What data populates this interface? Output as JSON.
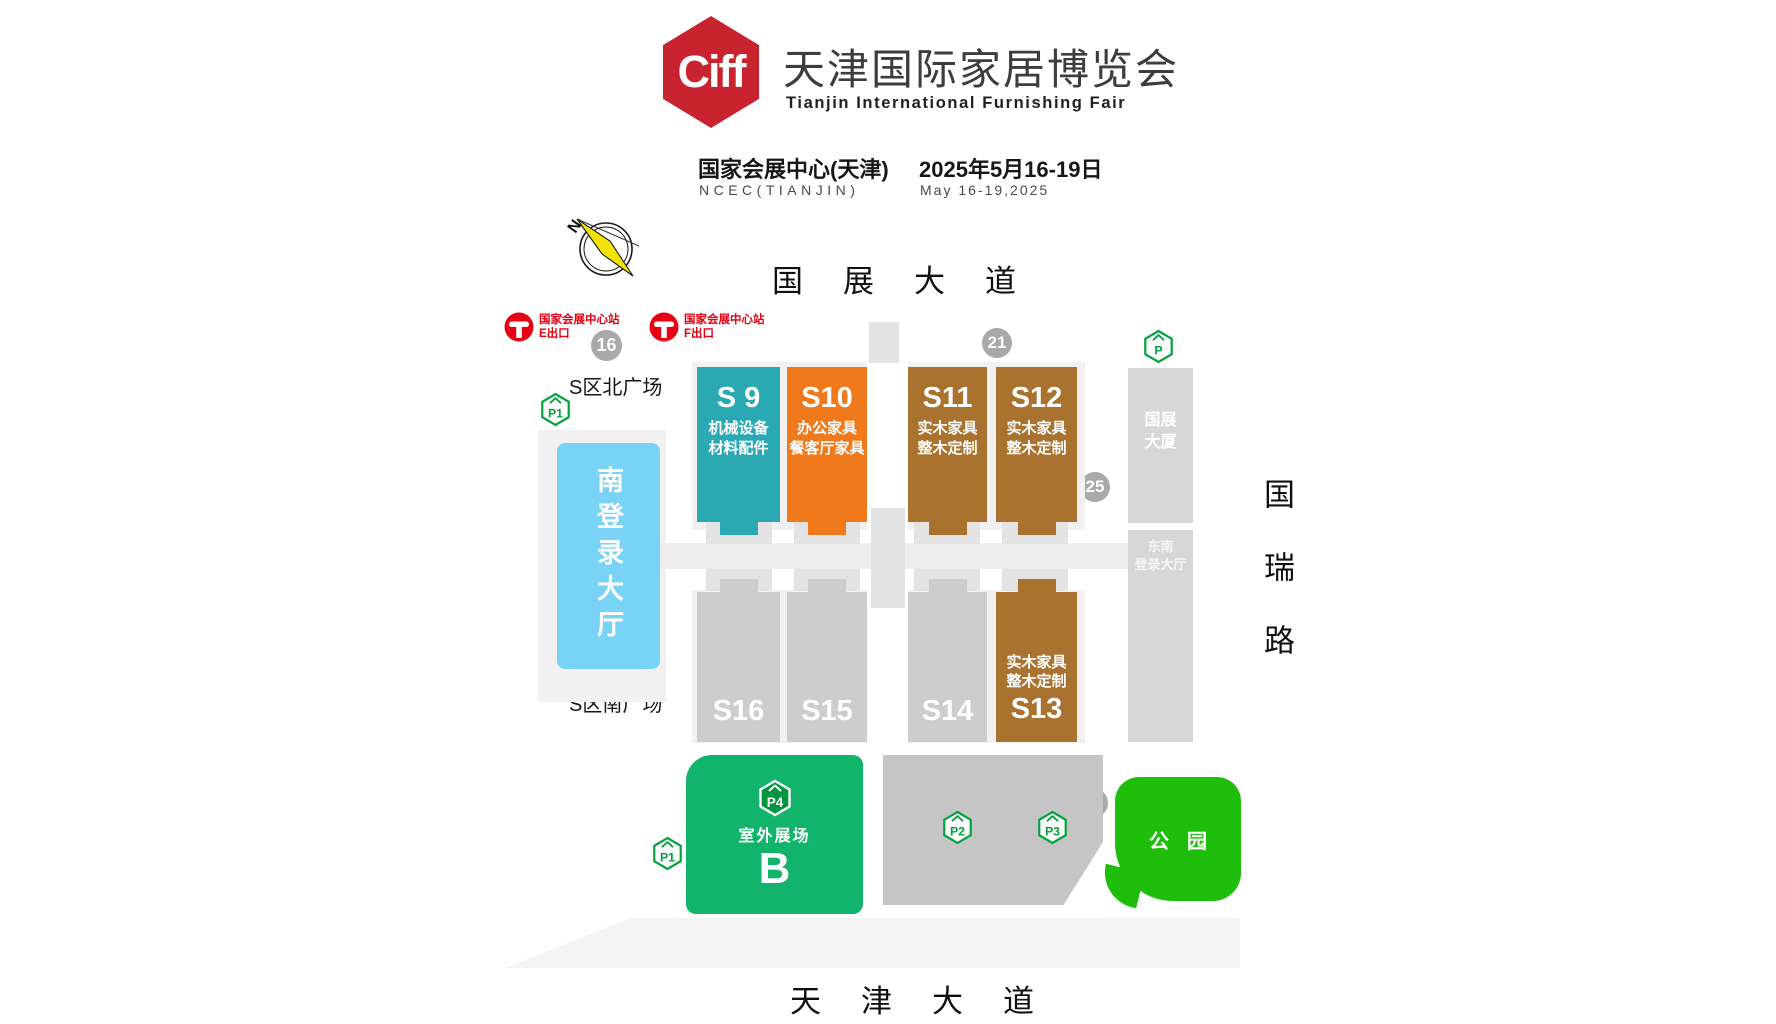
{
  "header": {
    "logo_text": "Ciff",
    "title_cn": "天津国际家居博览会",
    "title_en": "Tianjin International Furnishing Fair",
    "venue_cn": "国家会展中心(天津)",
    "venue_en": "NCEC(TIANJIN)",
    "date_cn": "2025年5月16-19日",
    "date_en": "May 16-19,2025",
    "brand_color": "#c8232e"
  },
  "compass": {
    "label": "N"
  },
  "roads": {
    "top": "国展大道",
    "right": "国瑞路",
    "bottom": "天津大道"
  },
  "metro": {
    "station": "国家会展中心站",
    "west_exit": "E出口",
    "east_exit": "F出口",
    "color": "#e60012"
  },
  "plazas": {
    "north": "S区北广场",
    "south": "S区南广场"
  },
  "gates": {
    "g16": "16",
    "g21": "21",
    "g25": "25",
    "g29": "29"
  },
  "parking": {
    "p1_north": "P1",
    "p1_south": "P1",
    "p2": "P2",
    "p3": "P3",
    "p4": "P4",
    "p_east": "P",
    "icon_green": "#00a33e"
  },
  "buildings": {
    "south_login_hall": "南登录大厅",
    "tower_line1": "国展",
    "tower_line2": "大厦",
    "se_login_line1": "东南",
    "se_login_line2": "登录大厅",
    "login_hall_blue": "#79d3f6"
  },
  "halls": {
    "s9": {
      "id": "S 9",
      "line1": "机械设备",
      "line2": "材料配件",
      "color": "#2ba9b2"
    },
    "s10": {
      "id": "S10",
      "line1": "办公家具",
      "line2": "餐客厅家具",
      "color": "#f0791c"
    },
    "s11": {
      "id": "S11",
      "line1": "实木家具",
      "line2": "整木定制",
      "color": "#a9732f"
    },
    "s12": {
      "id": "S12",
      "line1": "实木家具",
      "line2": "整木定制",
      "color": "#a9732f"
    },
    "s13": {
      "id": "S13",
      "line1": "实木家具",
      "line2": "整木定制",
      "color": "#a9732f"
    },
    "s14": {
      "id": "S14",
      "color": "#cdcdcd"
    },
    "s15": {
      "id": "S15",
      "color": "#cdcdcd"
    },
    "s16": {
      "id": "S16",
      "color": "#cdcdcd"
    }
  },
  "outdoor_area": {
    "label": "室外展场",
    "letter": "B",
    "color": "#12b36b"
  },
  "park": {
    "label": "公园",
    "color": "#1fbe0c"
  }
}
